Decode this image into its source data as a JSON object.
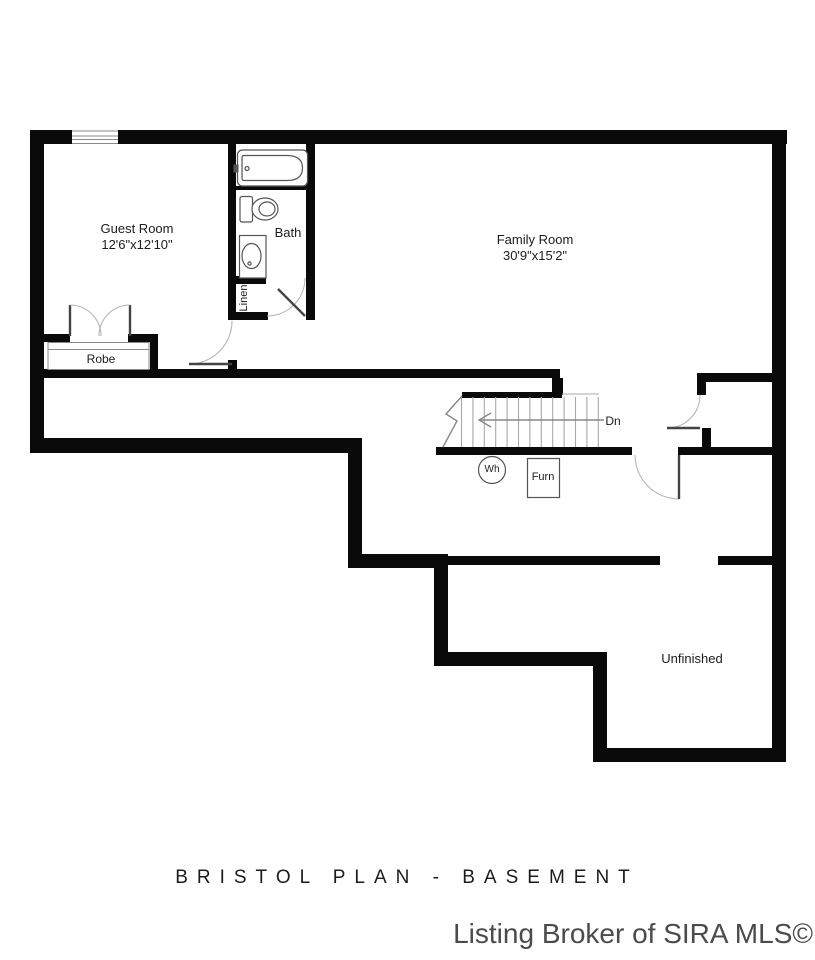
{
  "plan": {
    "title": "BRISTOL PLAN - BASEMENT",
    "watermark": "Listing Broker of SIRA MLS©",
    "rooms": {
      "guest_room": {
        "name": "Guest Room",
        "dims": "12'6\"x12'10\""
      },
      "bath": {
        "name": "Bath"
      },
      "linen": {
        "name": "Linen"
      },
      "robe": {
        "name": "Robe"
      },
      "family_room": {
        "name": "Family Room",
        "dims": "30'9\"x15'2\""
      },
      "unfinished": {
        "name": "Unfinished"
      }
    },
    "annotations": {
      "stairs_direction": "Dn",
      "water_heater": "Wh",
      "furnace": "Furn"
    },
    "colors": {
      "wall": "#0a0a0a",
      "fixture": "#555555",
      "door_arc": "#b5b5b5",
      "door_leaf": "#444444",
      "tread": "#a8a8a8",
      "text": "#1c1c1c",
      "watermark": "#4b4b4b",
      "background": "#ffffff"
    }
  }
}
